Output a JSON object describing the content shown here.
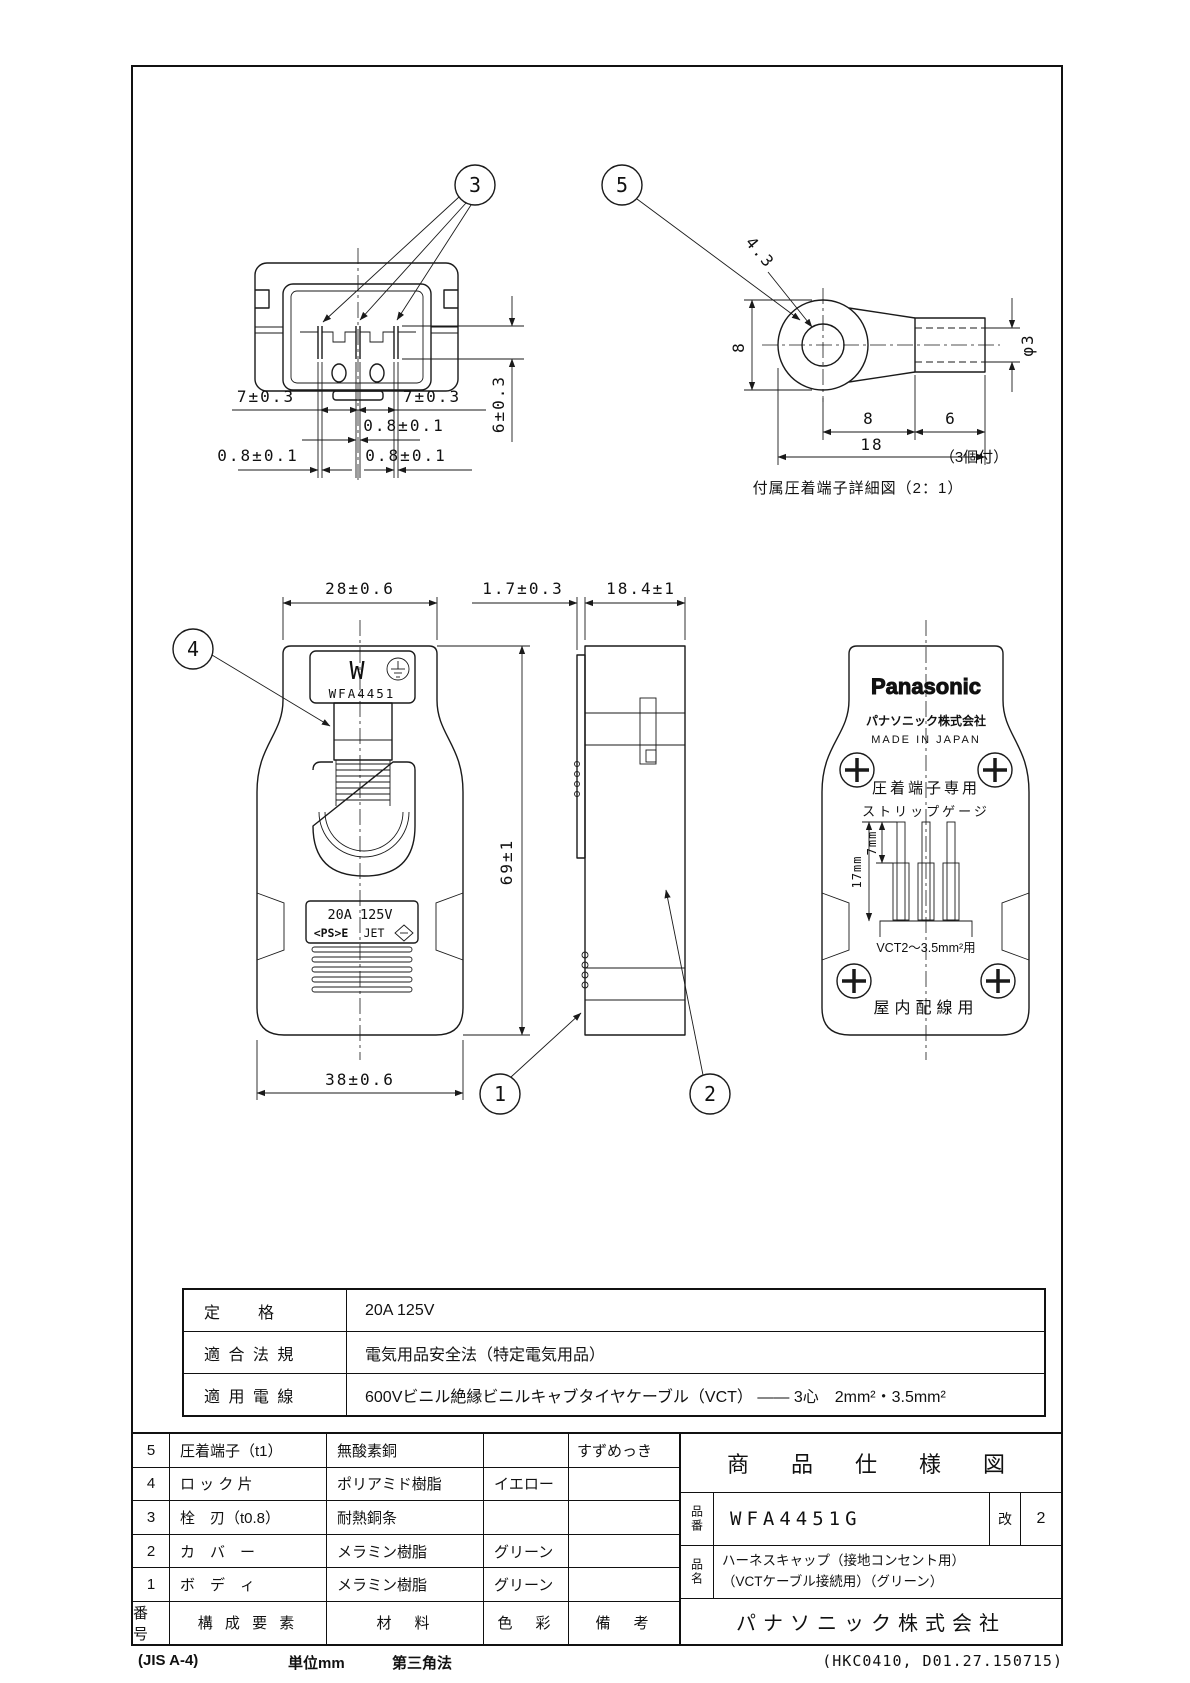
{
  "callouts": {
    "n1": "1",
    "n2": "2",
    "n3": "3",
    "n4": "4",
    "n5": "5"
  },
  "top_view": {
    "dim_pitch_left": "7±0.3",
    "dim_pitch_right": "7±0.3",
    "dim_blade_center": "0.8±0.1",
    "dim_blade_left": "0.8±0.1",
    "dim_blade_right": "0.8±0.1",
    "dim_blade_length": "6±0.3"
  },
  "terminal": {
    "dim_hole": "4.3",
    "dim_ring_width": "8",
    "dim_ring_length": "8",
    "dim_barrel_length": "6",
    "dim_total": "18",
    "dim_barrel_dia": "φ3",
    "qty": "（3個付）",
    "caption": "付属圧着端子詳細図（2：1）"
  },
  "front": {
    "dim_width_top": "28±0.6",
    "dim_latch": "1.7±0.3",
    "dim_depth": "18.4±1",
    "dim_height": "69±1",
    "dim_width_bottom": "38±0.6",
    "mark_w": "W",
    "model": "WFA4451",
    "rating": "20A 125V",
    "pse": "<PS>E",
    "jet": "JET"
  },
  "back": {
    "brand": "Panasonic",
    "company": "パナソニック株式会社",
    "made": "MADE IN JAPAN",
    "use_terminal": "圧着端子専用",
    "gauge": "ストリップゲージ",
    "gauge_7": "7mm",
    "gauge_17": "17mm",
    "cable": "VCT2〜3.5mm²用",
    "use_indoor": "屋内配線用"
  },
  "spec": {
    "rows": [
      {
        "label": "定　　格",
        "value": "20A 125V"
      },
      {
        "label": "適 合 法 規",
        "value": "電気用品安全法（特定電気用品）"
      },
      {
        "label": "適 用 電 線",
        "value": "600Vビニル絶縁ビニルキャブタイヤケーブル（VCT） ―― 3心　2mm²・3.5mm²"
      }
    ]
  },
  "parts": {
    "header": {
      "no": "番号",
      "component": "構 成 要 素",
      "material": "材　料",
      "color": "色　彩",
      "note": "備　考"
    },
    "rows": [
      {
        "no": "5",
        "component": "圧着端子（t1）",
        "material": "無酸素銅",
        "color": "",
        "note": "すずめっき"
      },
      {
        "no": "4",
        "component": "ロ ッ ク 片",
        "material": "ポリアミド樹脂",
        "color": "イエロー",
        "note": ""
      },
      {
        "no": "3",
        "component": "栓　刃（t0.8）",
        "material": "耐熱銅条",
        "color": "",
        "note": ""
      },
      {
        "no": "2",
        "component": "カ　バ　ー",
        "material": "メラミン樹脂",
        "color": "グリーン",
        "note": ""
      },
      {
        "no": "1",
        "component": "ボ　デ　ィ",
        "material": "メラミン樹脂",
        "color": "グリーン",
        "note": ""
      }
    ]
  },
  "title_block": {
    "title": "商　品　仕　様　図",
    "part_no_label": "品番",
    "part_no": "WFA4451G",
    "rev_label": "改",
    "rev": "2",
    "name_label": "品名",
    "name_line1": "ハーネスキャップ（接地コンセント用）",
    "name_line2": "（VCTケーブル接続用）（グリーン）",
    "company": "パナソニック株式会社"
  },
  "footer": {
    "paper": "(JIS A-4)",
    "unit": "単位mm",
    "projection": "第三角法",
    "doc_no": "(HKC0410, D01.27.150715)"
  }
}
